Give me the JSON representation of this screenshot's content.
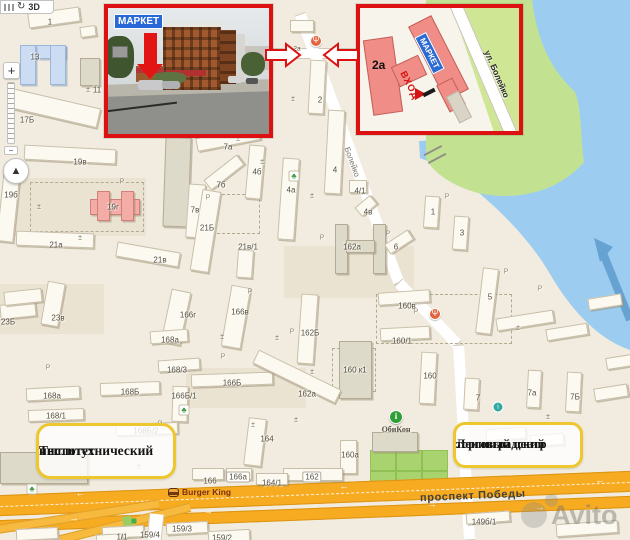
{
  "controls": {
    "rotate_icon": "↻",
    "view_3d": "3D",
    "zoom_in": "+",
    "zoom_out": "−",
    "compass_needle": "▲"
  },
  "insets": {
    "photo": {
      "sign_abv": "АБВ",
      "sign_market": "МАРКЕТ"
    },
    "plan": {
      "building_no": "2а",
      "sign_abv": "АБВ",
      "sign_market": "МАРКЕТ",
      "entrance": "ВХОД",
      "street": "ул. Болейко"
    }
  },
  "annotations": {
    "left_box": {
      "line1": "Теплотехнический",
      "line2": "институт"
    },
    "right_box": {
      "line1": "Ленинградский",
      "line2": "торговый центр"
    }
  },
  "streets": {
    "boleyko": "Болейко",
    "pobedy": "проспект Победы"
  },
  "pois_text": {
    "burger_king": "Burger King",
    "obikon": "ОбиКон"
  },
  "watermark": "Avito",
  "poi_glyphs": {
    "food": "Ψ",
    "info": "i",
    "teal": "i",
    "tree": "♣",
    "monument": "±",
    "parking": "P"
  },
  "map_labels": [
    {
      "t": "1",
      "x": 50,
      "y": 22
    },
    {
      "t": "13",
      "x": 35,
      "y": 57
    },
    {
      "t": "11",
      "x": 97,
      "y": 90
    },
    {
      "t": "17Б",
      "x": 27,
      "y": 120
    },
    {
      "t": "19в",
      "x": 80,
      "y": 162
    },
    {
      "t": "19б",
      "x": 11,
      "y": 195
    },
    {
      "t": "19г",
      "x": 113,
      "y": 207
    },
    {
      "t": "21а",
      "x": 56,
      "y": 245
    },
    {
      "t": "21в",
      "x": 160,
      "y": 260
    },
    {
      "t": "7в",
      "x": 195,
      "y": 210
    },
    {
      "t": "7а",
      "x": 228,
      "y": 147
    },
    {
      "t": "7б",
      "x": 221,
      "y": 185
    },
    {
      "t": "4б",
      "x": 257,
      "y": 172
    },
    {
      "t": "4а",
      "x": 291,
      "y": 190
    },
    {
      "t": "4",
      "x": 335,
      "y": 170
    },
    {
      "t": "2",
      "x": 320,
      "y": 100
    },
    {
      "t": "2а",
      "x": 297,
      "y": 49,
      "c": "sm"
    },
    {
      "t": "4/1",
      "x": 360,
      "y": 191
    },
    {
      "t": "4в",
      "x": 368,
      "y": 212
    },
    {
      "t": "21Б",
      "x": 207,
      "y": 228
    },
    {
      "t": "21в/1",
      "x": 248,
      "y": 247
    },
    {
      "t": "162а",
      "x": 352,
      "y": 247
    },
    {
      "t": "6",
      "x": 396,
      "y": 247
    },
    {
      "t": "23Б",
      "x": 8,
      "y": 322
    },
    {
      "t": "23в",
      "x": 58,
      "y": 318
    },
    {
      "t": "166г",
      "x": 188,
      "y": 315
    },
    {
      "t": "166в",
      "x": 240,
      "y": 312
    },
    {
      "t": "168а",
      "x": 170,
      "y": 340
    },
    {
      "t": "168/3",
      "x": 177,
      "y": 370
    },
    {
      "t": "168Б",
      "x": 130,
      "y": 392
    },
    {
      "t": "166Б/1",
      "x": 184,
      "y": 396
    },
    {
      "t": "168а",
      "x": 52,
      "y": 396
    },
    {
      "t": "168/1",
      "x": 56,
      "y": 416
    },
    {
      "t": "168Б/2",
      "x": 146,
      "y": 431
    },
    {
      "t": "162Б",
      "x": 310,
      "y": 333
    },
    {
      "t": "160в",
      "x": 407,
      "y": 306
    },
    {
      "t": "160/1",
      "x": 402,
      "y": 341
    },
    {
      "t": "160 к1",
      "x": 355,
      "y": 370
    },
    {
      "t": "166Б",
      "x": 232,
      "y": 383
    },
    {
      "t": "162а",
      "x": 307,
      "y": 394
    },
    {
      "t": "1",
      "x": 433,
      "y": 212
    },
    {
      "t": "3",
      "x": 462,
      "y": 233
    },
    {
      "t": "5",
      "x": 490,
      "y": 297
    },
    {
      "t": "160",
      "x": 430,
      "y": 376
    },
    {
      "t": "7",
      "x": 478,
      "y": 398
    },
    {
      "t": "7а",
      "x": 532,
      "y": 393
    },
    {
      "t": "7Б",
      "x": 575,
      "y": 397
    },
    {
      "t": "164",
      "x": 267,
      "y": 439
    },
    {
      "t": "160а",
      "x": 350,
      "y": 455
    },
    {
      "t": "162",
      "x": 312,
      "y": 477,
      "c": "plate"
    },
    {
      "t": "166",
      "x": 210,
      "y": 481
    },
    {
      "t": "166а",
      "x": 238,
      "y": 477,
      "c": "plate"
    },
    {
      "t": "164/1",
      "x": 272,
      "y": 483
    },
    {
      "t": "159/3",
      "x": 182,
      "y": 529
    },
    {
      "t": "159/4",
      "x": 150,
      "y": 535
    },
    {
      "t": "1/1",
      "x": 122,
      "y": 537
    },
    {
      "t": "159/2",
      "x": 222,
      "y": 538
    },
    {
      "t": "149б/1",
      "x": 484,
      "y": 522
    }
  ],
  "pois": [
    {
      "k": "food",
      "x": 316,
      "y": 41
    },
    {
      "k": "food",
      "x": 435,
      "y": 314
    },
    {
      "k": "info",
      "x": 396,
      "y": 417,
      "label": "ОбиКон"
    },
    {
      "k": "teal",
      "x": 498,
      "y": 407
    },
    {
      "k": "tree",
      "x": 16,
      "y": 171
    },
    {
      "k": "tree",
      "x": 32,
      "y": 489
    },
    {
      "k": "tree",
      "x": 294,
      "y": 176
    },
    {
      "k": "tree",
      "x": 184,
      "y": 410
    },
    {
      "k": "monument",
      "x": 88,
      "y": 90
    },
    {
      "k": "monument",
      "x": 293,
      "y": 99
    },
    {
      "k": "monument",
      "x": 39,
      "y": 207
    },
    {
      "k": "monument",
      "x": 80,
      "y": 238
    },
    {
      "k": "monument",
      "x": 238,
      "y": 139
    },
    {
      "k": "monument",
      "x": 262,
      "y": 162
    },
    {
      "k": "monument",
      "x": 312,
      "y": 196
    },
    {
      "k": "monument",
      "x": 222,
      "y": 337
    },
    {
      "k": "monument",
      "x": 277,
      "y": 338
    },
    {
      "k": "monument",
      "x": 312,
      "y": 372
    },
    {
      "k": "monument",
      "x": 253,
      "y": 425
    },
    {
      "k": "monument",
      "x": 518,
      "y": 328
    },
    {
      "k": "monument",
      "x": 548,
      "y": 417
    },
    {
      "k": "monument",
      "x": 139,
      "y": 467
    },
    {
      "k": "monument",
      "x": 296,
      "y": 420
    },
    {
      "k": "parking",
      "x": 122,
      "y": 182
    },
    {
      "k": "parking",
      "x": 208,
      "y": 198
    },
    {
      "k": "parking",
      "x": 250,
      "y": 292
    },
    {
      "k": "parking",
      "x": 322,
      "y": 238
    },
    {
      "k": "parking",
      "x": 388,
      "y": 234
    },
    {
      "k": "parking",
      "x": 447,
      "y": 197
    },
    {
      "k": "parking",
      "x": 416,
      "y": 312
    },
    {
      "k": "parking",
      "x": 506,
      "y": 272
    },
    {
      "k": "parking",
      "x": 540,
      "y": 289
    },
    {
      "k": "parking",
      "x": 160,
      "y": 424
    },
    {
      "k": "parking",
      "x": 48,
      "y": 368
    },
    {
      "k": "parking",
      "x": 292,
      "y": 332
    },
    {
      "k": "parking",
      "x": 223,
      "y": 357
    },
    {
      "k": "parking",
      "x": 470,
      "y": 452
    },
    {
      "k": "dot",
      "x": 134,
      "y": 521
    }
  ],
  "road_arrows": [
    {
      "d": "←",
      "x": 80,
      "y": 493
    },
    {
      "d": "←",
      "x": 218,
      "y": 491
    },
    {
      "d": "←",
      "x": 344,
      "y": 486
    },
    {
      "d": "←",
      "x": 600,
      "y": 480
    },
    {
      "d": "→",
      "x": 74,
      "y": 518
    },
    {
      "d": "→",
      "x": 208,
      "y": 511
    },
    {
      "d": "→",
      "x": 432,
      "y": 504
    },
    {
      "d": "→",
      "x": 540,
      "y": 507
    }
  ],
  "colors": {
    "accent_red": "#dd1111",
    "note_yellow": "#eec72e",
    "water": "#9ccdf0",
    "green": "#c3e291",
    "highway_orange": "#f7ab21",
    "highlight_blue": "#cbdcf3",
    "building_pink": "#f3aca6"
  }
}
